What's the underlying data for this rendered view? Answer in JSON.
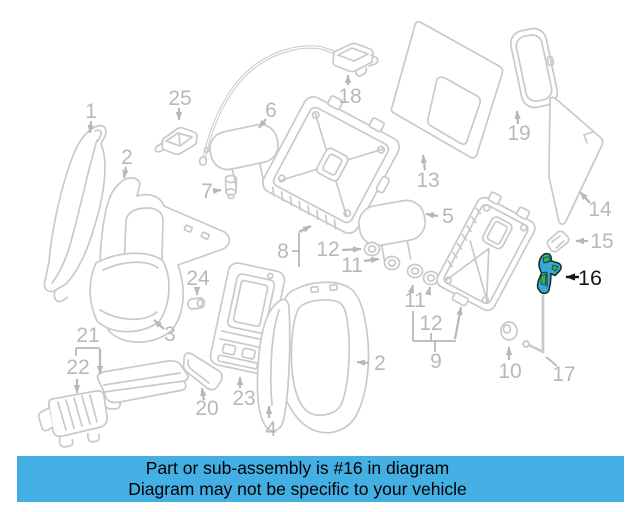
{
  "banner": {
    "line1": "Part or sub-assembly is #16 in diagram",
    "line2": "Diagram may not be specific to your vehicle",
    "bg_color": "#44AFE3",
    "text_color": "#000000"
  },
  "diagram": {
    "line_color": "#C9C9C9",
    "label_color": "#B8B8B8",
    "highlight": {
      "label": "16",
      "fill_color": "#38A8DB",
      "accent_color": "#36B04F",
      "outline_color": "#14381C",
      "label_color": "#161616"
    },
    "callouts": [
      {
        "label": "1",
        "x": 91,
        "y": 118
      },
      {
        "label": "2",
        "x": 127,
        "y": 164
      },
      {
        "label": "25",
        "x": 180,
        "y": 105
      },
      {
        "label": "6",
        "x": 271,
        "y": 117
      },
      {
        "label": "7",
        "x": 207,
        "y": 198
      },
      {
        "label": "18",
        "x": 350,
        "y": 103
      },
      {
        "label": "13",
        "x": 428,
        "y": 187
      },
      {
        "label": "19",
        "x": 519,
        "y": 140
      },
      {
        "label": "5",
        "x": 448,
        "y": 223
      },
      {
        "label": "14",
        "x": 600,
        "y": 216
      },
      {
        "label": "15",
        "x": 602,
        "y": 248
      },
      {
        "label": "8",
        "x": 283,
        "y": 258
      },
      {
        "label": "12",
        "x": 328,
        "y": 256
      },
      {
        "label": "11",
        "x": 352,
        "y": 272
      },
      {
        "label": "11",
        "x": 415,
        "y": 307
      },
      {
        "label": "12",
        "x": 431,
        "y": 330
      },
      {
        "label": "9",
        "x": 436,
        "y": 368
      },
      {
        "label": "10",
        "x": 510,
        "y": 378
      },
      {
        "label": "17",
        "x": 564,
        "y": 381
      },
      {
        "label": "2",
        "x": 380,
        "y": 370
      },
      {
        "label": "24",
        "x": 198,
        "y": 285
      },
      {
        "label": "3",
        "x": 170,
        "y": 341
      },
      {
        "label": "21",
        "x": 88,
        "y": 342
      },
      {
        "label": "22",
        "x": 78,
        "y": 374
      },
      {
        "label": "20",
        "x": 207,
        "y": 415
      },
      {
        "label": "23",
        "x": 244,
        "y": 405
      },
      {
        "label": "4",
        "x": 271,
        "y": 436
      }
    ]
  }
}
